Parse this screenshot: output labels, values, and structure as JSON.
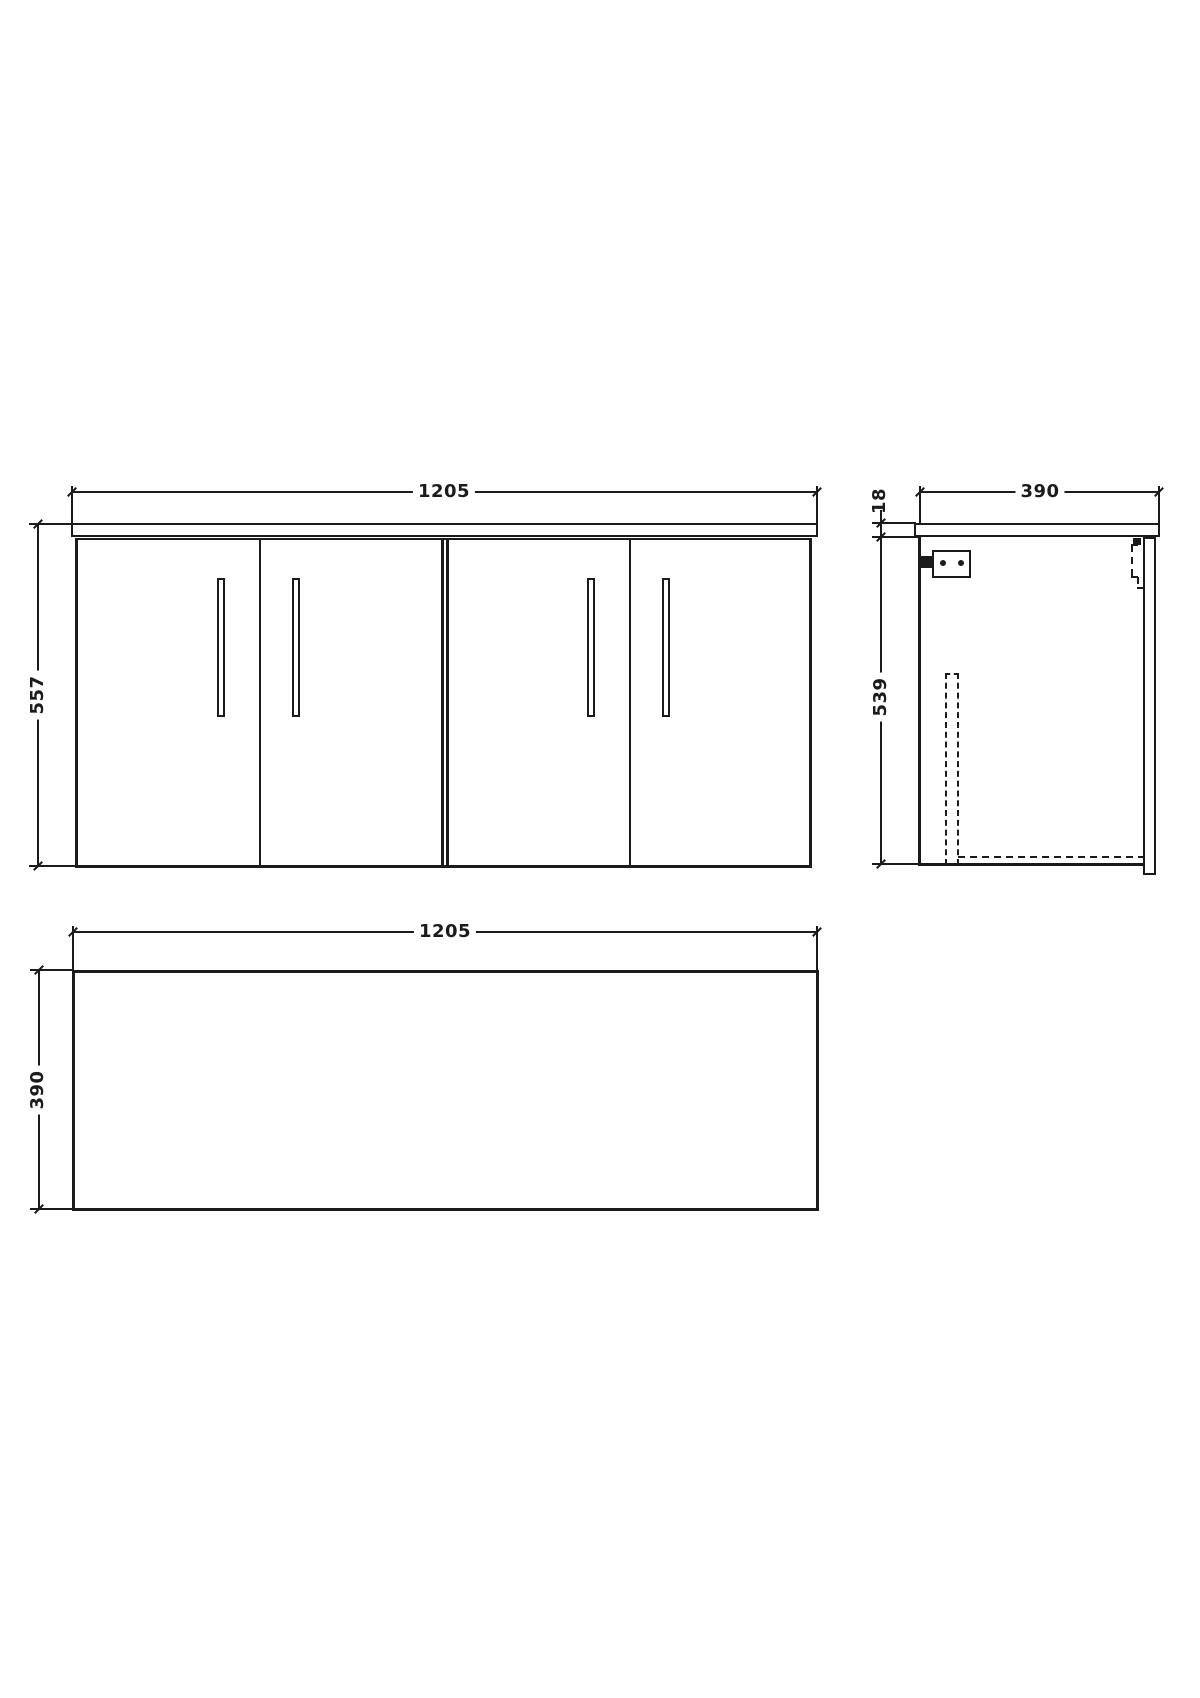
{
  "title": "Wall-hung 4-door vanity unit technical drawing",
  "colors": {
    "background": "#ffffff",
    "line": "#1b1b1b"
  },
  "views": {
    "front": {
      "label_width": "1205",
      "label_height": "557"
    },
    "side": {
      "label_width": "390",
      "label_worktop_thickness": "18",
      "label_height": "539"
    },
    "plan": {
      "label_width": "1205",
      "label_depth": "390"
    }
  }
}
